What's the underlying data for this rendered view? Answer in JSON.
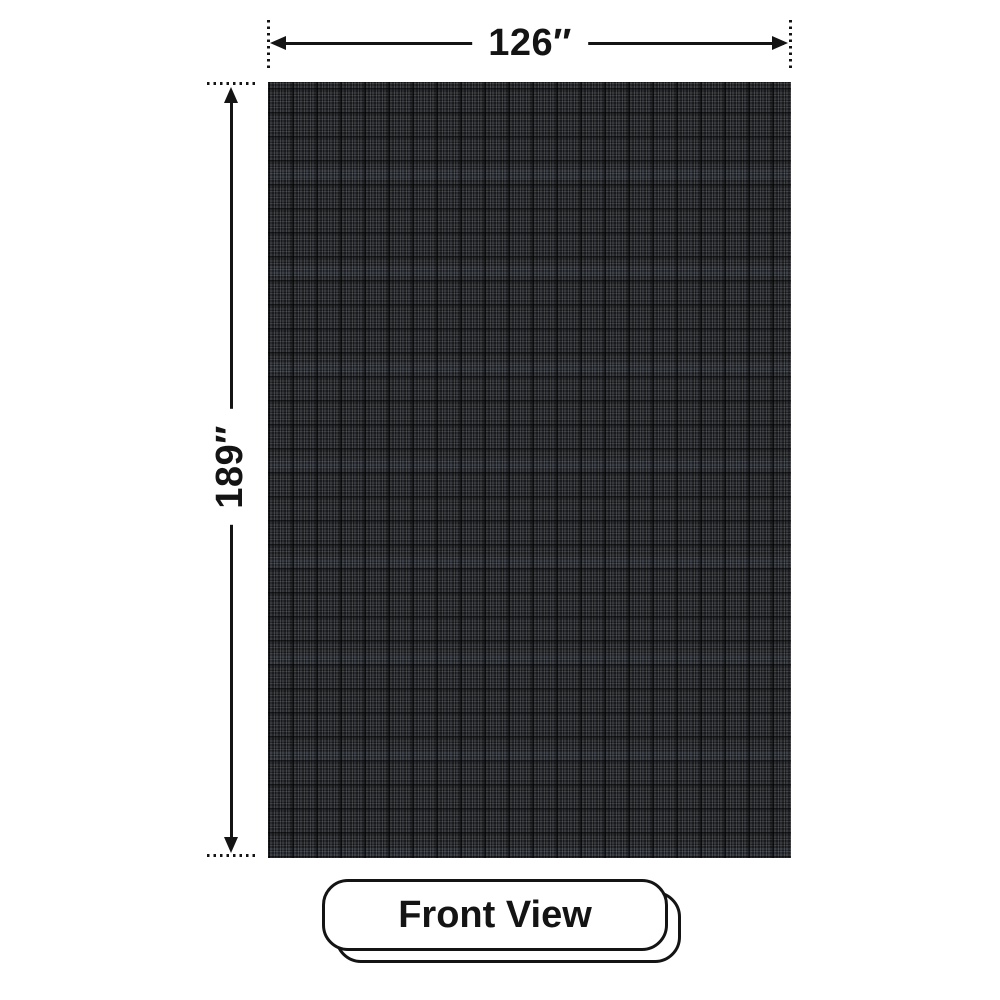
{
  "diagram": {
    "width_dimension": {
      "label": "126″"
    },
    "height_dimension": {
      "label": "189″"
    },
    "view_badge": {
      "label": "Front View"
    },
    "colors": {
      "background": "#ffffff",
      "line": "#141414",
      "panel_base": "#24262a",
      "panel_grid_light": "#45484e",
      "panel_grid_dark": "#0d0e10"
    }
  }
}
